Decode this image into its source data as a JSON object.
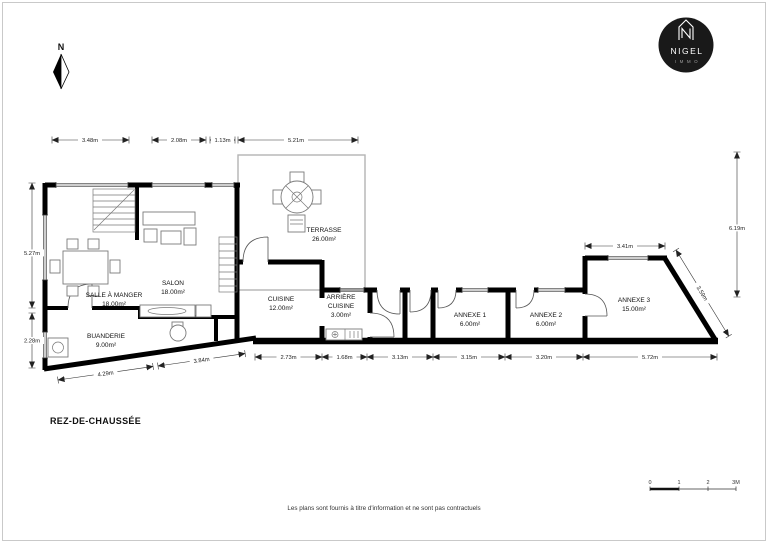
{
  "page": {
    "title": "REZ-DE-CHAUSSÉE",
    "footer": "Les plans sont fournis à titre d'information et ne sont pas contractuels"
  },
  "north": {
    "label": "N"
  },
  "logo": {
    "name": "NIGEL",
    "sub": "IMMO"
  },
  "rooms": [
    {
      "name": "SALLE À MANGER",
      "area": "18.00m²"
    },
    {
      "name": "SALON",
      "area": "18.00m²"
    },
    {
      "name": "BUANDERIE",
      "area": "9.00m²"
    },
    {
      "name": "CUISINE",
      "area": "12.00m²"
    },
    {
      "name": "ARRIÈRE CUISINE",
      "line1": "ARRIÈRE",
      "line2": "CUISINE",
      "area": "3.00m²"
    },
    {
      "name": "TERRASSE",
      "area": "26.00m²"
    },
    {
      "name": "ANNEXE 1",
      "area": "6.00m²"
    },
    {
      "name": "ANNEXE 2",
      "area": "6.00m²"
    },
    {
      "name": "ANNEXE 3",
      "area": "15.00m²"
    }
  ],
  "dimensions": {
    "top": [
      "3.48m",
      "2.08m",
      "1.13m",
      "5.21m"
    ],
    "left": [
      "5.27m",
      "2.28m"
    ],
    "right": [
      "6.19m",
      "3.41m",
      "3.59m"
    ],
    "bottom": [
      "2.73m",
      "1.68m",
      "3.13m",
      "3.15m",
      "3.20m",
      "5.72m"
    ],
    "bottom_left": [
      "4.29m",
      "3.84m"
    ]
  },
  "scalebar": {
    "labels": [
      "0",
      "1",
      "2",
      "3M"
    ]
  }
}
